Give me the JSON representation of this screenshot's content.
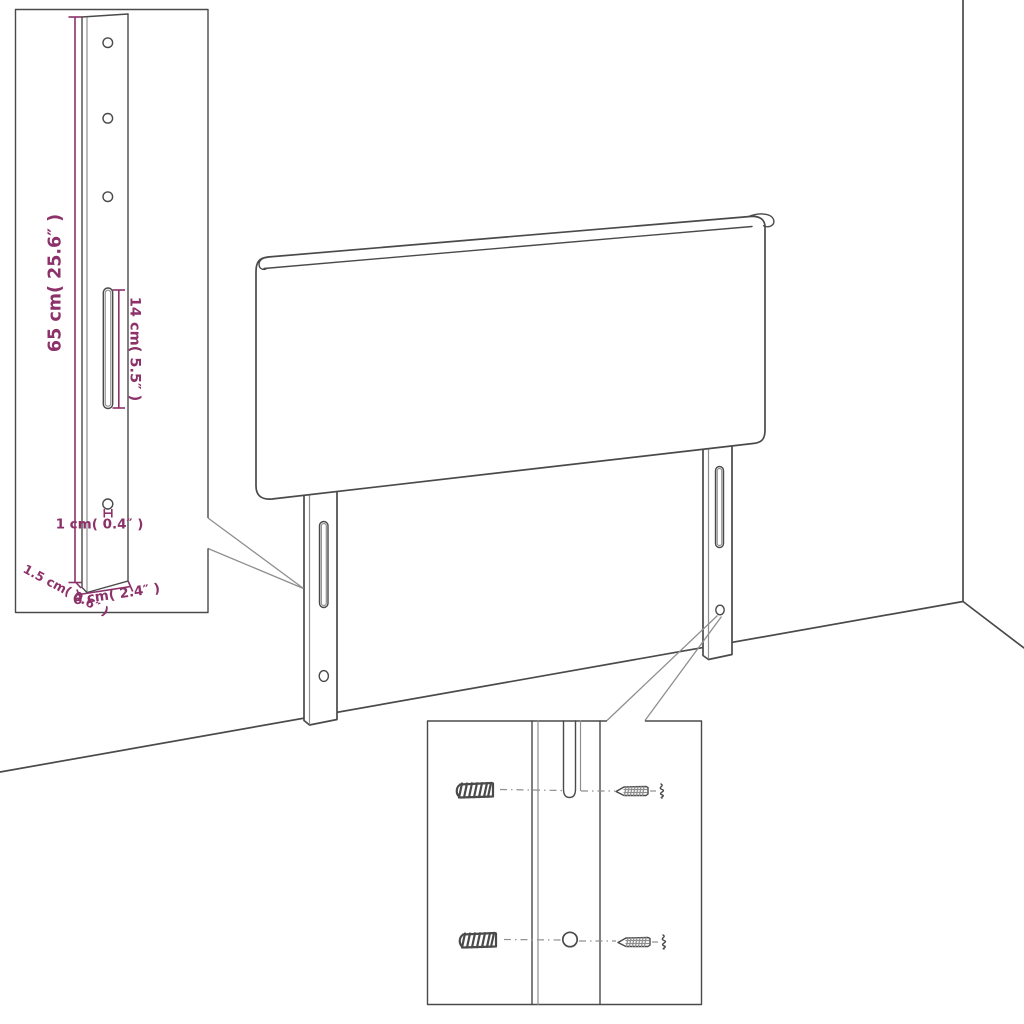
{
  "colors": {
    "bg": "#ffffff",
    "line": "#4a4a4a",
    "line-soft": "#8f8f8f",
    "dim": "#8c3169"
  },
  "diagram": {
    "labels": {
      "leg_height": "65 cm( 25.6″ )",
      "slot_length": "14 cm( 5.5″ )",
      "hole_diameter": "1 cm( 0.4″ )",
      "leg_thickness": "1.5 cm( 0.6″ )",
      "leg_width": "6 cm( 2.4″ )"
    }
  }
}
